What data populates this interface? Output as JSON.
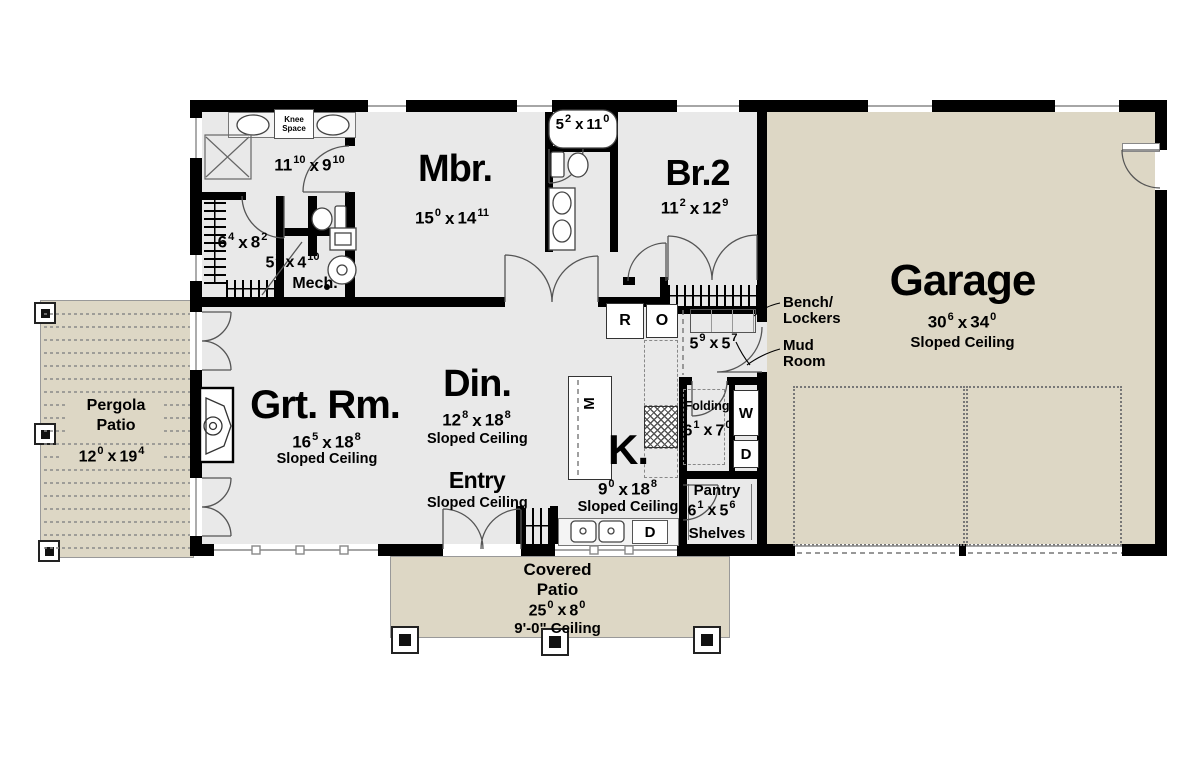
{
  "sep": "x",
  "labels": {
    "knee1": "Knee",
    "knee2": "Space",
    "mech": "Mech.",
    "bench1": "Bench/",
    "bench2": "Lockers",
    "mud1": "Mud",
    "mud2": "Room",
    "folding": "Folding",
    "washer": "W",
    "dryer": "D",
    "fridge": "R",
    "oven": "O",
    "micro": "M",
    "dishwasher": "D",
    "shelves": "Shelves",
    "sloped": "Sloped Ceiling",
    "ceiling9": "9'-0\" Ceiling"
  },
  "rooms": {
    "master_bath": {
      "w": "11",
      "wi": "10",
      "h": "9",
      "hi": "10"
    },
    "mbr": {
      "name": "Mbr.",
      "w": "15",
      "wi": "0",
      "h": "14",
      "hi": "11"
    },
    "bath2": {
      "w": "5",
      "wi": "2",
      "h": "11",
      "hi": "0"
    },
    "br2": {
      "name": "Br.2",
      "w": "11",
      "wi": "2",
      "h": "12",
      "hi": "9"
    },
    "wic": {
      "w": "6",
      "wi": "4",
      "h": "8",
      "hi": "2"
    },
    "mech": {
      "w": "5",
      "wi": "2",
      "h": "4",
      "hi": "10"
    },
    "garage": {
      "name": "Garage",
      "w": "30",
      "wi": "6",
      "h": "34",
      "hi": "0"
    },
    "mud": {
      "w": "5",
      "wi": "9",
      "h": "5",
      "hi": "7"
    },
    "laundry": {
      "w": "6",
      "wi": "1",
      "h": "7",
      "hi": "0"
    },
    "pantry": {
      "name": "Pantry",
      "w": "6",
      "wi": "1",
      "h": "5",
      "hi": "6"
    },
    "kitchen": {
      "name": "K.",
      "w": "9",
      "wi": "0",
      "h": "18",
      "hi": "8"
    },
    "dining": {
      "name": "Din.",
      "w": "12",
      "wi": "8",
      "h": "18",
      "hi": "8"
    },
    "great": {
      "name": "Grt. Rm.",
      "w": "16",
      "wi": "5",
      "h": "18",
      "hi": "8"
    },
    "entry": {
      "name": "Entry"
    },
    "pergola": {
      "name1": "Pergola",
      "name2": "Patio",
      "w": "12",
      "wi": "0",
      "h": "19",
      "hi": "4"
    },
    "covered": {
      "name1": "Covered",
      "name2": "Patio",
      "w": "25",
      "wi": "0",
      "h": "8",
      "hi": "0"
    }
  },
  "colors": {
    "wall": "#000000",
    "interior_floor": "#e9e9e9",
    "outdoor_floor": "#ddd7c5",
    "line": "#555555"
  }
}
